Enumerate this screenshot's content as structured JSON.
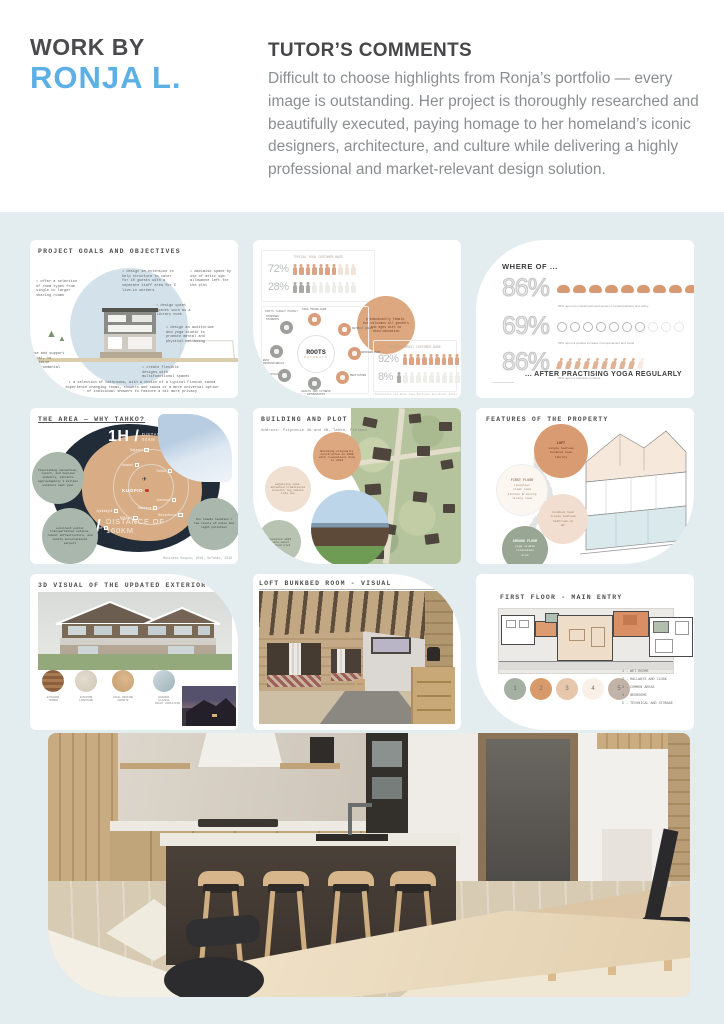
{
  "colors": {
    "page_bg": "#e3ecee",
    "accent_blue": "#5cb0e5",
    "terracotta": "#d99c77"
  },
  "header": {
    "work_by": "WORK BY",
    "name": "RONJA L.",
    "comments_title": "TUTOR’S COMMENTS",
    "comments_body": "Difficult to choose highlights from Ronja’s portfolio — every image is outstanding. Her project is thoroughly researched and beautifully executed, paying homage to her homeland’s iconic designers, architecture, and culture while delivering a highly professional and market-relevant design solution."
  },
  "slides": {
    "goals": {
      "title": "PROJECT GOALS AND OBJECTIVES",
      "annotations": [
        "• offer a selection of room types from single to larger sharing rooms",
        "• design an extension to help structure to cater for 10 guests with a separate staff area for 5 live-in workers",
        "• maximise space by use of attic sqm allowance left for the plot",
        "• design quiet spaces such as a library nook",
        "• design an auditorium and yoga studio to promote mental and physical wellbeing",
        "• create flexible designs with multifunctional spaces",
        "use and support local, to minimise environmental impact",
        "• a selection of bathrooms, with a choice of a typical Finnish sauna experience changing rooms, showers and sauna or a more universal option of individual showers to feature a bit more privacy"
      ]
    },
    "customers": {
      "box1_title": "TYPICAL YOGA CUSTOMER BASE",
      "rows": [
        {
          "pct": "72%",
          "total": 10,
          "filled": 7,
          "shape": "person",
          "on": "#dba585",
          "off": "#f2e3d8"
        },
        {
          "pct": "28%",
          "total": 10,
          "filled": 3,
          "shape": "person",
          "on": "#a7aaa5",
          "off": "#ededea"
        }
      ],
      "map_title": "ROOTS TARGET MARKET",
      "center": "ROOTS",
      "center_sub": "RETREATS",
      "nodes": [
        "YOGA TRAVELLERS",
        "RETREAT GOERS",
        "WORKSHOPPERS",
        "MEDITATORS",
        "HEALTH AND FITNESS ENTHUSIASTS",
        "SPIRITUAL YOGIS",
        "BUSY PROFESSIONALS",
        "STRESSED STUDENTS"
      ],
      "bubble": "predominantly female, but welcomes all genders and ages with no discrimination",
      "box2_title": "ROOTS CURRENT CUSTOMER BASE",
      "rows2": [
        {
          "pct": "92%",
          "total": 10,
          "filled": 9,
          "shape": "person",
          "on": "#dba585",
          "off": "#f2e3d8"
        },
        {
          "pct": "8%",
          "total": 10,
          "filled": 1,
          "shape": "person",
          "on": "#a7aaa5",
          "off": "#ededea"
        }
      ],
      "source": "(Statistics via Book Yoga Retreats and Roots data)"
    },
    "results": {
      "title": "WHERE OF ...",
      "rows": [
        {
          "pct": "86%",
          "total": 10,
          "filled": 9,
          "shape": "brain",
          "on": "#d79a72",
          "off": "#f4e3d6",
          "caption": "86% report an overall improved sense of mental wellness and clarity"
        },
        {
          "pct": "69%",
          "total": 10,
          "filled": 7,
          "shape": "smiley",
          "on": "#b4b7b4",
          "off": "#e6e7e6",
          "caption": "69% report a positive increase in temperament and mood"
        },
        {
          "pct": "86%",
          "total": 10,
          "filled": 9,
          "shape": "runner",
          "on": "#e0b396",
          "off": "#f6ebe2",
          "caption": "86% report a reduction in stress"
        }
      ],
      "footer": "... AFTER PRACTISING YOGA REGULARLY"
    },
    "area": {
      "title": "THE AREA — WHY TAHKO?",
      "dist1_big": "1H /",
      "dist1_small": "DISTANCE OF\n90KM",
      "dist2_big": "2H /",
      "dist2_small": "DISTANCE OF\n160KM",
      "main_city": "KUOPIO",
      "plane_icon": "✈",
      "cities": [
        "Kajaani",
        "Vuokatti",
        "Iisalmi",
        "Tahko",
        "Joensuu",
        "Varkaus",
        "Jyväskylä",
        "Mikkeli",
        "Savonlinna",
        "Tampere",
        "Vaasa"
      ],
      "bubbles": [
        "flourishing connection, resort, and tourism industry, attracts approximately 1 million visitors each year",
        "excellent public transportation options, robust infrastructure, and nearby international airport",
        "the remote location = low levels of noise and light pollution"
      ],
      "source": "Business Kuopio, 2019; GoTahko, 2019"
    },
    "building": {
      "title": "BUILDING AND PLOT",
      "address": "Address: Piipontie 4A and 4B, Tahko, Finland",
      "bubbles": [
        "Building originally constructed in 1998 with renovations done in 2013",
        "adjoining semi-detached traditional Finnish log cabins into one",
        "expansive 1883 square meter combined plot"
      ]
    },
    "features": {
      "title": "FEATURES OF THE PROPERTY",
      "circles": [
        {
          "head": "LOFT",
          "body": "single bedroom\nbunkbed room\nlibrary"
        },
        {
          "head": "FIRST FLOOR",
          "body": "reception\ncloak room\nkitchen & dining\nliving room"
        },
        {
          "head": "",
          "body": "bunkbed room\ntriple bedroom\nbathroom x2\nWC"
        },
        {
          "head": "GROUND FLOOR",
          "body": "yoga studio\nrelaxation\narea"
        }
      ]
    },
    "exterior": {
      "title": "3D VISUAL OF THE UPDATED EXTERIOR",
      "materials": [
        "EXTERIOR\nTIMBER",
        "EXTERIOR\nLIMESTONE",
        "LOCAL ROOFING\nGRANITE",
        "WINDOWS\nGLAZING"
      ],
      "night_label": "NIGHT VARIATION"
    },
    "loft": {
      "title": "LOFT BUNKBED ROOM - VISUAL"
    },
    "floorplan": {
      "title": "FIRST FLOOR - MAIN ENTRY",
      "legend_nums": [
        "1",
        "2",
        "3",
        "4",
        "5"
      ],
      "legend": [
        "1 - WET ROOMS",
        "2 - HALLWAYS AND CLOAK",
        "3 - COMMON AREAS",
        "4 - BEDROOMS",
        "5 - TECHNICAL AND STORAGE"
      ]
    }
  }
}
